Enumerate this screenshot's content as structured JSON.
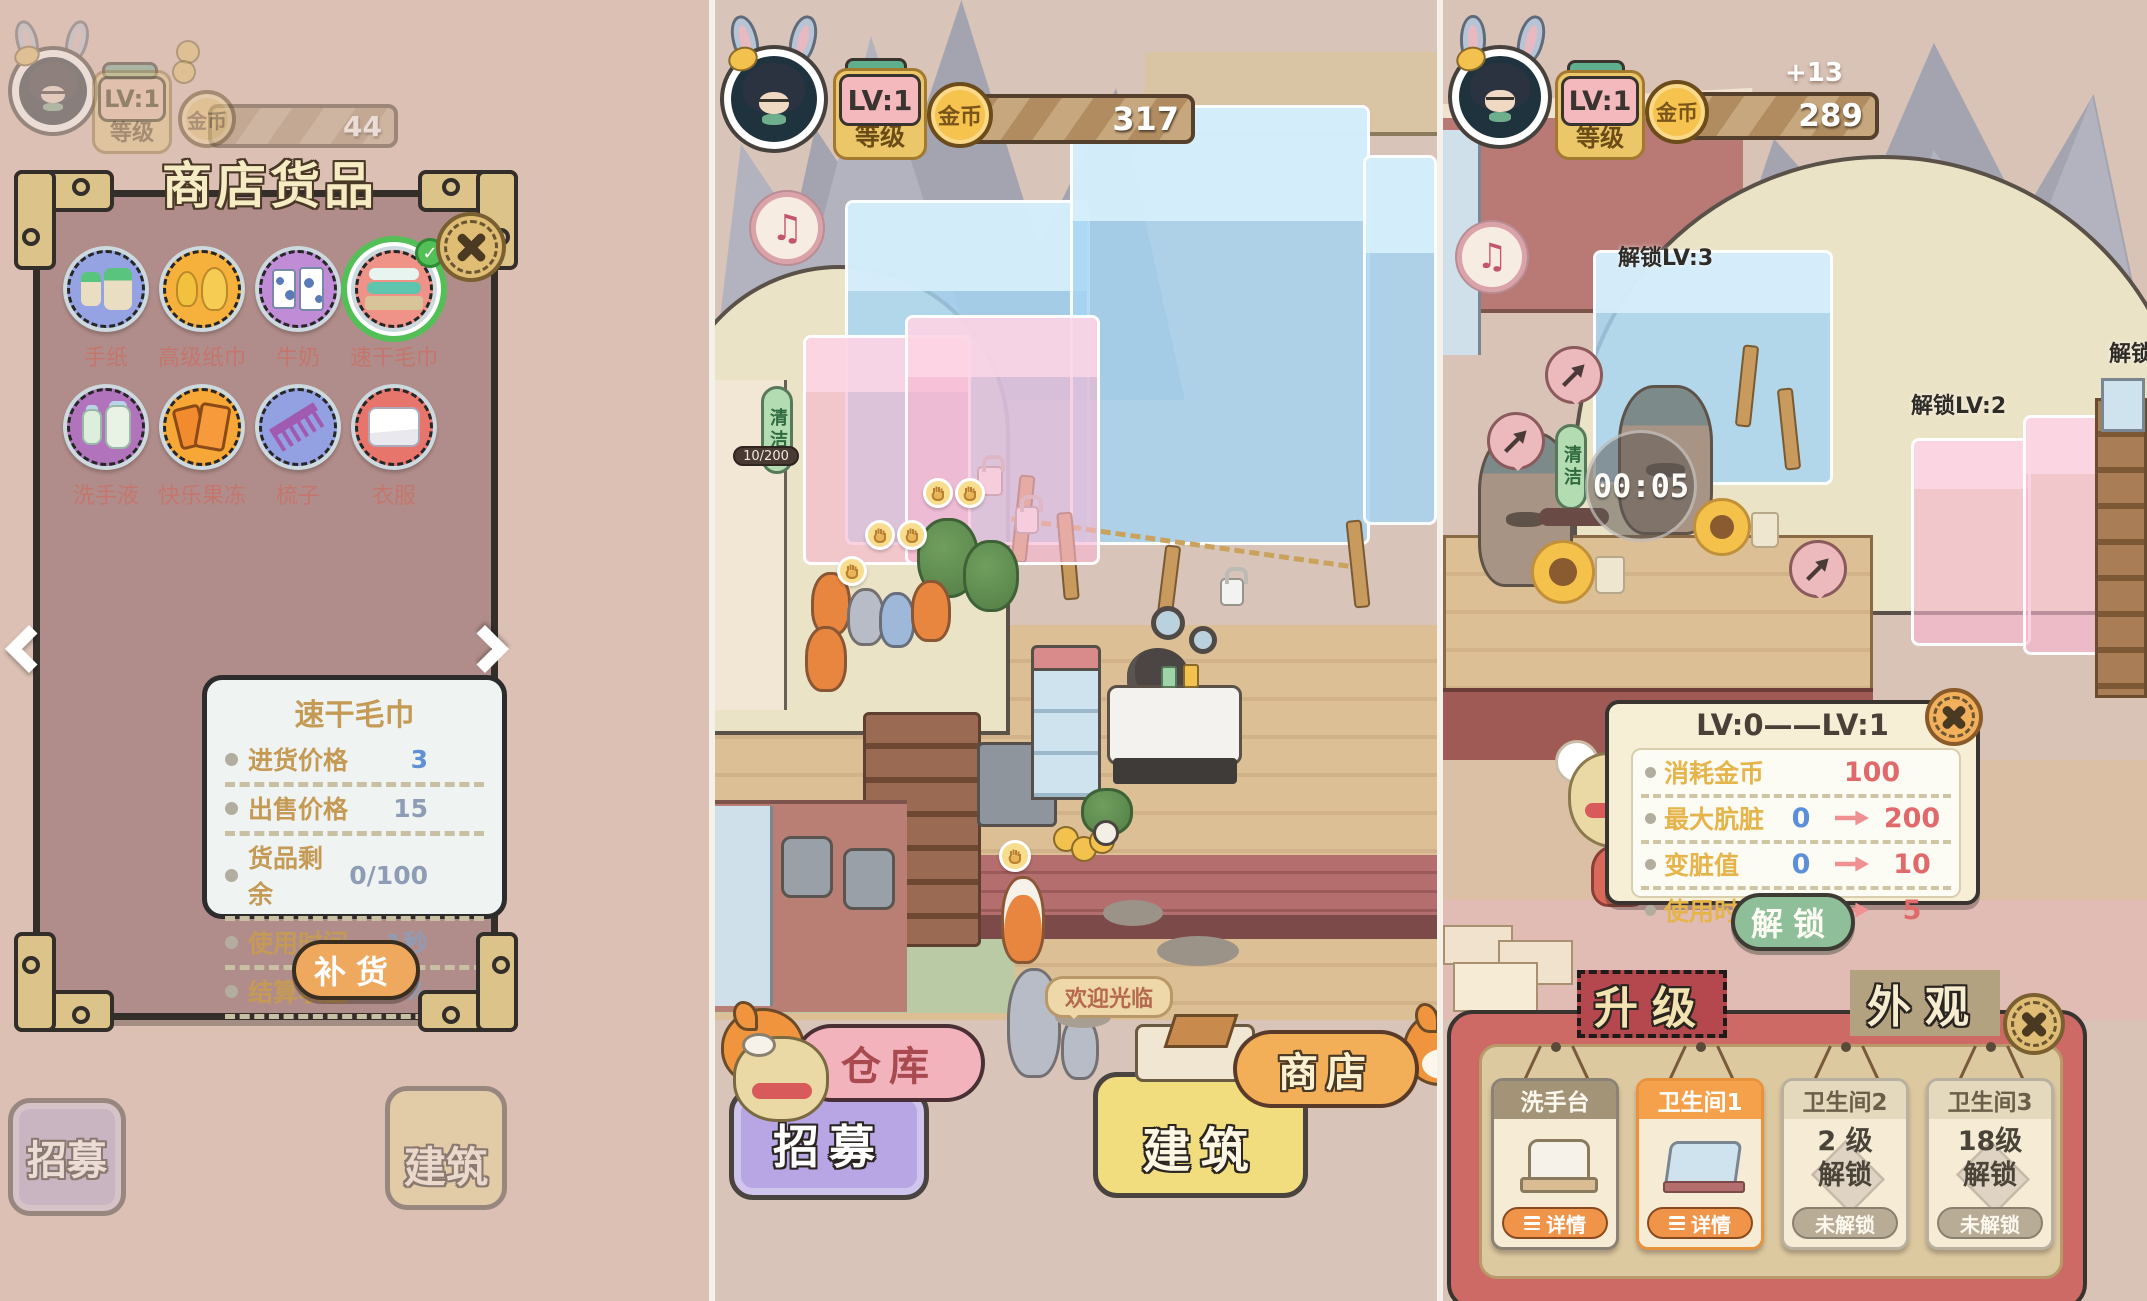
{
  "icons": {
    "music": "♫",
    "check": "✓"
  },
  "left": {
    "hud": {
      "lv": "LV:1",
      "level_label": "等级",
      "coin_label": "金币",
      "coin_value": "44"
    },
    "dialog": {
      "title": "商店货品",
      "items": [
        {
          "name": "手纸",
          "bg": "#96a3e3"
        },
        {
          "name": "高级纸巾",
          "bg": "#f6b03c"
        },
        {
          "name": "牛奶",
          "bg": "#c08cd6"
        },
        {
          "name": "速干毛巾",
          "bg": "#ef9287",
          "selected": true
        },
        {
          "name": "洗手液",
          "bg": "#b273bd"
        },
        {
          "name": "快乐果冻",
          "bg": "#f6a735"
        },
        {
          "name": "梳子",
          "bg": "#93a0e2"
        },
        {
          "name": "衣服",
          "bg": "#e8756c"
        }
      ],
      "detail": {
        "title": "速干毛巾",
        "rows": [
          {
            "label": "进货价格",
            "value": "3"
          },
          {
            "label": "出售价格",
            "value": "15"
          },
          {
            "label": "货品剩余",
            "value": "0/100"
          },
          {
            "label": "使用时间",
            "value": "1秒"
          },
          {
            "label": "结算收益",
            "value": "0%"
          }
        ],
        "restock_label": "补货"
      }
    },
    "faded": {
      "recruit": "招募",
      "build": "建筑"
    }
  },
  "middle": {
    "hud": {
      "lv": "LV:1",
      "level_label": "等级",
      "coin_label": "金币",
      "coin_value": "317"
    },
    "scene": {
      "clean_label": "清洁",
      "stock_meter": "10/200",
      "welcome_bubble": "欢迎光临"
    },
    "nav": {
      "warehouse": "仓库",
      "shop": "商店",
      "recruit": "招募",
      "build": "建筑"
    }
  },
  "right": {
    "hud": {
      "lv": "LV:1",
      "level_label": "等级",
      "coin_label": "金币",
      "coin_value": "289",
      "coin_gain": "+13"
    },
    "scene": {
      "unlock_lv3": "解锁LV:3",
      "unlock_lv2": "解锁LV:2",
      "unlock_edge": "解锁",
      "clean_label": "清洁",
      "timer": "00:05"
    },
    "upgrade_dialog": {
      "title": "LV:0——LV:1",
      "rows": [
        {
          "label": "消耗金币",
          "old": "",
          "new": "100"
        },
        {
          "label": "最大肮脏",
          "old": "0",
          "new": "200"
        },
        {
          "label": "变脏值",
          "old": "0",
          "new": "10"
        },
        {
          "label": "使用时间",
          "old": "0",
          "new": "5"
        }
      ],
      "unlock_label": "解锁"
    },
    "tabs": {
      "upgrade": "升级",
      "appearance": "外观"
    },
    "cards": [
      {
        "title": "洗手台",
        "button": "详情"
      },
      {
        "title": "卫生间1",
        "button": "详情"
      },
      {
        "title": "卫生间2",
        "req1": "2 级",
        "req2": "解锁",
        "button": "未解锁"
      },
      {
        "title": "卫生间3",
        "req1": "18级",
        "req2": "解锁",
        "button": "未解锁"
      }
    ]
  }
}
